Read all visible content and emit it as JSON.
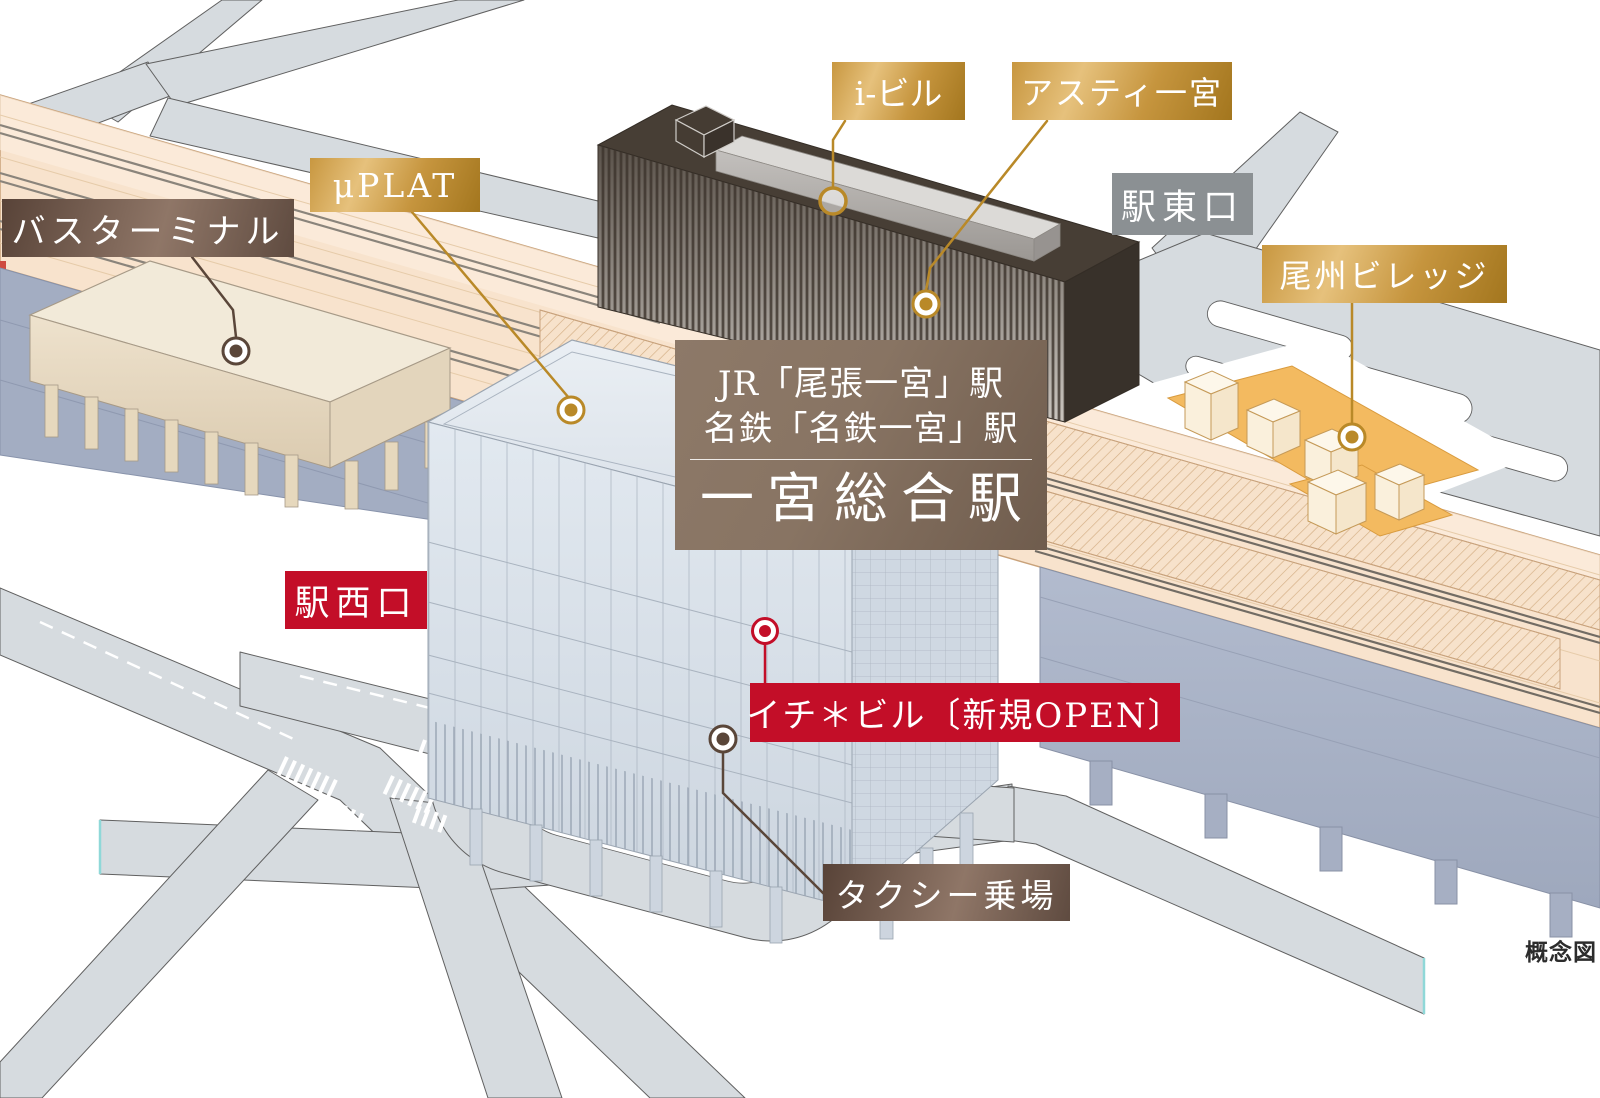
{
  "note": "概念図",
  "station_panel": {
    "jr_line": "JR「尾張一宮」駅",
    "meitetsu_line": "名鉄「名鉄一宮」駅",
    "station_name": "一宮総合駅"
  },
  "labels": {
    "bus_terminal": "バスターミナル",
    "muplat": "μPLAT",
    "i_building": "i-ビル",
    "asty_ichinomiya": "アスティ一宮",
    "east_exit": "駅東口",
    "bishu_village": "尾州ビレッジ",
    "west_exit": "駅西口",
    "ichi_building": "イチ＊ビル〔新規OPEN〕",
    "taxi_stand": "タクシー乗場"
  },
  "icons": {
    "poi_marker_gold": "circle-ring-dot",
    "poi_marker_brown": "circle-ring-dot",
    "poi_marker_red": "circle-ring-dot",
    "poi_marker_open_ring": "circle-ring"
  },
  "colors": {
    "gold_accent": "#b98928",
    "brown_accent": "#5a4639",
    "red_accent": "#c30e28",
    "gray_label_bg": "#8b9093",
    "railway_deck": "#f8e3cd",
    "viaduct_wall": "#aab3c7",
    "road": "#d6dbdf",
    "village_ground": "#f3ba60"
  }
}
